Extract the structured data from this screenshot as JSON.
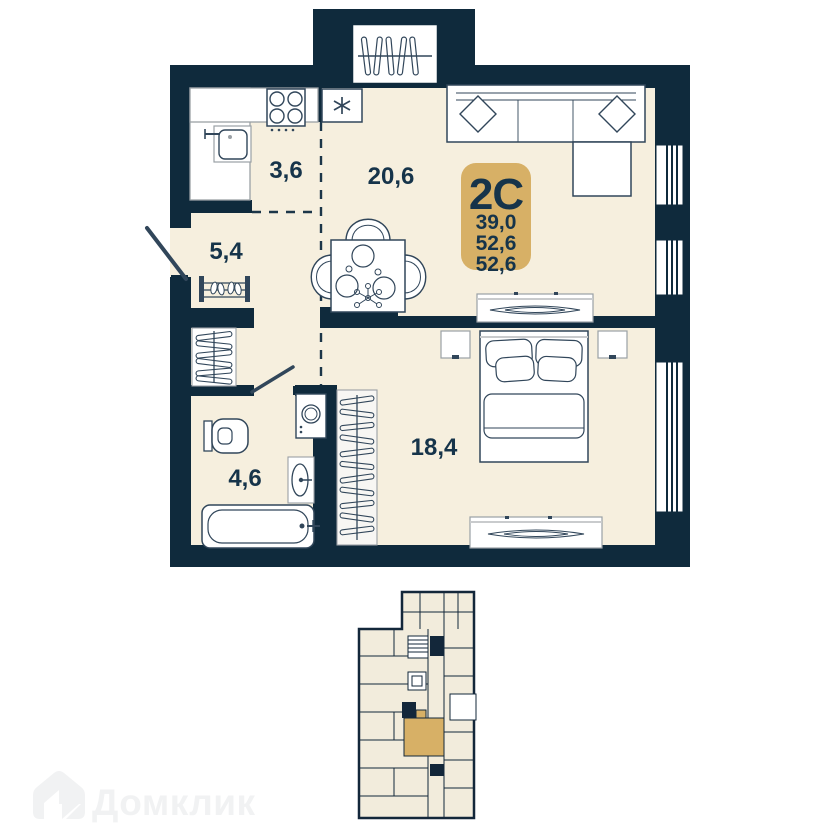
{
  "apartment": {
    "type_label": "2C",
    "area_rows": [
      "39,0",
      "52,6",
      "52,6"
    ]
  },
  "room_labels": {
    "kitchen": "3,6",
    "living_room": "20,6",
    "hallway": "5,4",
    "bathroom": "4,6",
    "bedroom": "18,4"
  },
  "watermark": {
    "brand": "Домклик"
  },
  "colors": {
    "wall": "#0F2A3C",
    "floor": "#F6EFDE",
    "accent_gold": "#D7B066",
    "label_text": "#16344A",
    "watermark_gray": "#F1F2F3"
  }
}
